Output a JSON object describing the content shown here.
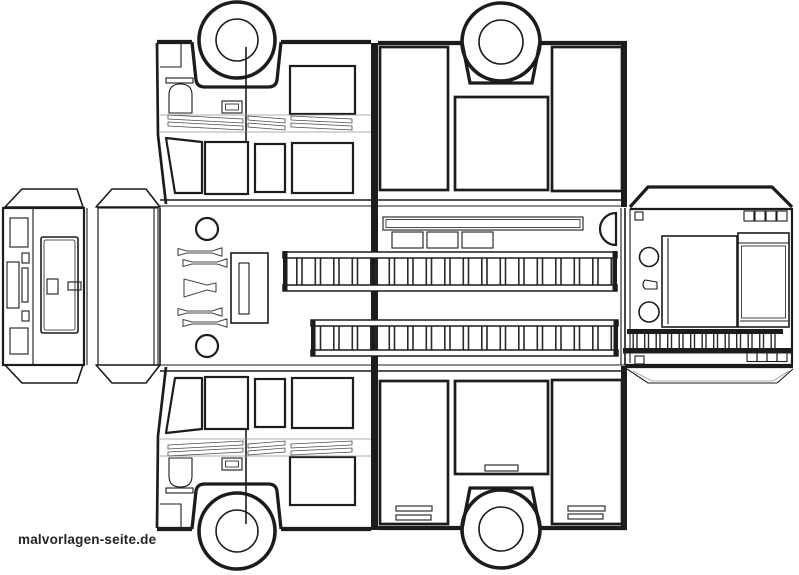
{
  "colors": {
    "bg": "#ffffff",
    "ink": "#1c1c1c",
    "ink-soft": "#4a4a4a",
    "ink-faint": "#949494"
  },
  "watermark": {
    "text": "malvorlagen-seite.de"
  }
}
